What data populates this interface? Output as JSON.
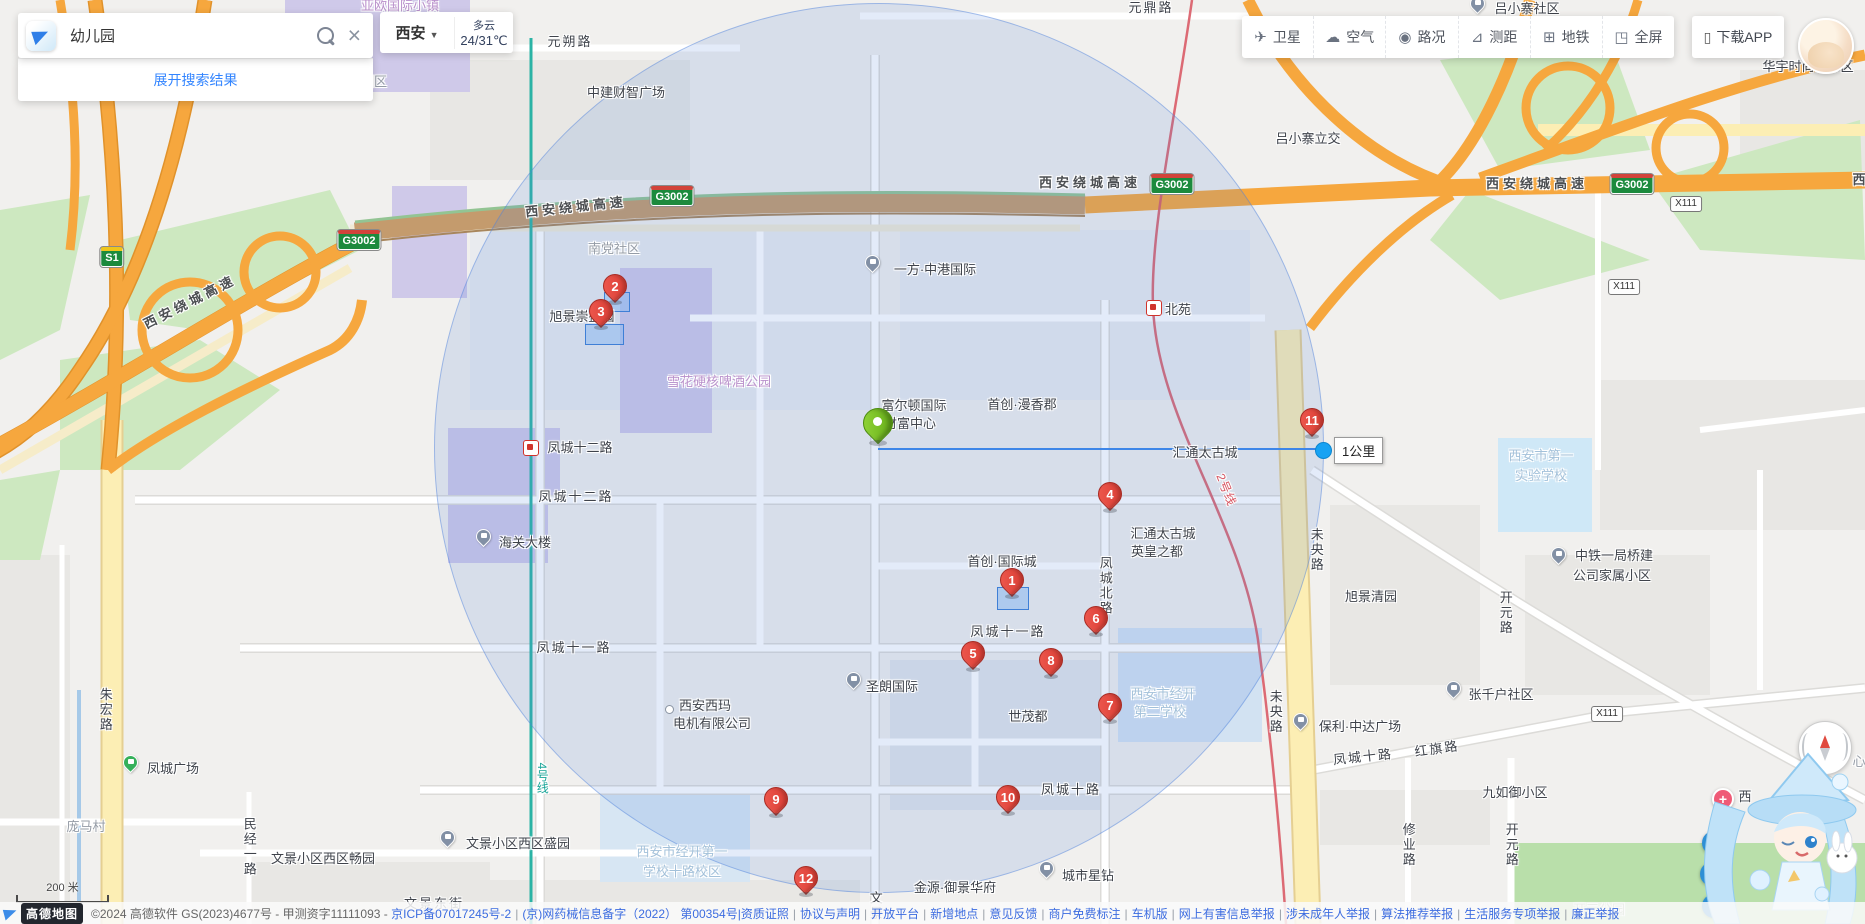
{
  "app": {
    "brand": "高德地图"
  },
  "search": {
    "query": "幼儿园",
    "expand_label": "展开搜索结果"
  },
  "city": {
    "name": "西安",
    "caret": "▼",
    "weather": "多云",
    "temp": "24/31℃"
  },
  "toolbar": {
    "items": [
      {
        "id": "satellite",
        "icon": "✈",
        "label": "卫星"
      },
      {
        "id": "air",
        "icon": "☁",
        "label": "空气"
      },
      {
        "id": "traffic",
        "icon": "◉",
        "label": "路况"
      },
      {
        "id": "measure",
        "icon": "⊿",
        "label": "测距"
      },
      {
        "id": "metro",
        "icon": "⊞",
        "label": "地铁"
      },
      {
        "id": "fullscreen",
        "icon": "◳",
        "label": "全屏"
      }
    ],
    "download_icon": "▯",
    "download_label": "下载APP"
  },
  "measure": {
    "label": "1公里",
    "x1": 878,
    "y": 449,
    "x2": 1322,
    "circle": {
      "cx": 878,
      "cy": 447,
      "r": 444
    }
  },
  "scale": {
    "label": "200 米"
  },
  "controls": {
    "buttons": [
      {
        "id": "refresh",
        "glyph": "↻",
        "x": 1714,
        "y": 843
      },
      {
        "id": "locate",
        "glyph": "◎",
        "x": 1712,
        "y": 874
      },
      {
        "id": "settings",
        "glyph": "⚙",
        "x": 1714,
        "y": 906
      }
    ]
  },
  "footer": {
    "logo_text": "高德地图",
    "copyright": "©2024 高德软件 GS(2023)4677号 - 甲测资字11111093 -",
    "links": [
      "京ICP备07017245号-2",
      "(京)网药械信息备字（2022） 第00354号|资质证照",
      "协议与声明",
      "开放平台",
      "新增地点",
      "意见反馈",
      "商户免费标注",
      "车机版",
      "网上有害信息举报",
      "涉未成年人举报",
      "算法推荐举报",
      "生活服务专项举报",
      "廉正举报"
    ]
  },
  "map": {
    "center_pin": {
      "x": 878,
      "y": 423
    },
    "markers": [
      {
        "n": "1",
        "x": 1012,
        "y": 580
      },
      {
        "n": "2",
        "x": 615,
        "y": 286
      },
      {
        "n": "3",
        "x": 601,
        "y": 311
      },
      {
        "n": "4",
        "x": 1110,
        "y": 494
      },
      {
        "n": "5",
        "x": 973,
        "y": 653
      },
      {
        "n": "6",
        "x": 1096,
        "y": 618
      },
      {
        "n": "7",
        "x": 1110,
        "y": 705
      },
      {
        "n": "8",
        "x": 1051,
        "y": 660
      },
      {
        "n": "9",
        "x": 776,
        "y": 799
      },
      {
        "n": "10",
        "x": 1008,
        "y": 797
      },
      {
        "n": "11",
        "x": 1312,
        "y": 420
      },
      {
        "n": "12",
        "x": 806,
        "y": 878
      }
    ],
    "highlight_buildings": [
      {
        "x": 997,
        "y": 587,
        "w": 30,
        "h": 21
      },
      {
        "x": 604,
        "y": 292,
        "w": 24,
        "h": 18
      },
      {
        "x": 585,
        "y": 324,
        "w": 37,
        "h": 19
      }
    ],
    "stations": [
      {
        "name": "凤城十二路",
        "x": 530,
        "y": 447
      },
      {
        "name": "北苑",
        "x": 1153,
        "y": 307
      }
    ],
    "badges": [
      {
        "t": "S1",
        "k": "s",
        "x": 112,
        "y": 257
      },
      {
        "t": "G3002",
        "k": "g",
        "x": 359,
        "y": 240
      },
      {
        "t": "G3002",
        "k": "g",
        "x": 672,
        "y": 196
      },
      {
        "t": "G3002",
        "k": "g",
        "x": 1172,
        "y": 184
      },
      {
        "t": "G3002",
        "k": "g",
        "x": 1632,
        "y": 184
      },
      {
        "t": "X111",
        "k": "x",
        "x": 1686,
        "y": 204
      },
      {
        "t": "X111",
        "k": "x",
        "x": 1624,
        "y": 287
      },
      {
        "t": "X111",
        "k": "x",
        "x": 1607,
        "y": 714
      }
    ],
    "icons": [
      {
        "k": "building",
        "x": 872,
        "y": 268
      },
      {
        "k": "building",
        "x": 1477,
        "y": 9
      },
      {
        "k": "building",
        "x": 483,
        "y": 542
      },
      {
        "k": "building",
        "x": 853,
        "y": 685
      },
      {
        "k": "building",
        "x": 1558,
        "y": 560
      },
      {
        "k": "building",
        "x": 1453,
        "y": 694
      },
      {
        "k": "building",
        "x": 1300,
        "y": 726
      },
      {
        "k": "building",
        "x": 1046,
        "y": 874
      },
      {
        "k": "building",
        "x": 447,
        "y": 843
      },
      {
        "k": "tree",
        "x": 130,
        "y": 768
      },
      {
        "k": "dot",
        "x": 668,
        "y": 708
      },
      {
        "k": "plus",
        "x": 1721,
        "y": 797,
        "glyph": "+"
      }
    ],
    "labels": [
      {
        "t": "元朔路",
        "x": 570,
        "y": 42,
        "c": "road"
      },
      {
        "t": "元鼎路",
        "x": 1151,
        "y": 8,
        "c": "road"
      },
      {
        "t": "亚欧国际小镇",
        "x": 400,
        "y": 6,
        "c": "purple"
      },
      {
        "t": "园区",
        "x": 374,
        "y": 82,
        "c": "muted"
      },
      {
        "t": "中建财智广场",
        "x": 626,
        "y": 93,
        "c": "area"
      },
      {
        "t": "吕小寨社区",
        "x": 1527,
        "y": 9,
        "c": "area"
      },
      {
        "t": "华宇时尚城东区",
        "x": 1808,
        "y": 67,
        "c": "area"
      },
      {
        "t": "吕小寨立交",
        "x": 1308,
        "y": 139,
        "c": "area"
      },
      {
        "t": "西安绕城高速",
        "x": 190,
        "y": 302,
        "c": "hw",
        "r": -27
      },
      {
        "t": "西安绕城高速",
        "x": 576,
        "y": 207,
        "c": "hw",
        "r": -6
      },
      {
        "t": "西安绕城高速",
        "x": 1090,
        "y": 183,
        "c": "hw"
      },
      {
        "t": "西安绕城高速",
        "x": 1537,
        "y": 184,
        "c": "hw"
      },
      {
        "t": "西",
        "x": 1861,
        "y": 180,
        "c": "hw"
      },
      {
        "t": "南党社区",
        "x": 614,
        "y": 249,
        "c": "muted"
      },
      {
        "t": "旭景崇盛园",
        "x": 582,
        "y": 317,
        "c": "area"
      },
      {
        "t": "雪花硬核啤酒公园",
        "x": 719,
        "y": 382,
        "c": "purple"
      },
      {
        "t": "一方·中港国际",
        "x": 935,
        "y": 270,
        "c": "area"
      },
      {
        "t": "北苑",
        "x": 1178,
        "y": 310,
        "c": "area"
      },
      {
        "t": "首创·漫香郡",
        "x": 1022,
        "y": 405,
        "c": "area"
      },
      {
        "t": "富尔顿国际",
        "x": 914,
        "y": 406,
        "c": "area"
      },
      {
        "t": "财富中心",
        "x": 910,
        "y": 424,
        "c": "area"
      },
      {
        "t": "汇通太古城",
        "x": 1205,
        "y": 453,
        "c": "area"
      },
      {
        "t": "凤城十二路",
        "x": 580,
        "y": 448,
        "c": "area"
      },
      {
        "t": "凤城十二路",
        "x": 576,
        "y": 497,
        "c": "road"
      },
      {
        "t": "汇通太古城",
        "x": 1163,
        "y": 534,
        "c": "area"
      },
      {
        "t": "英皇之都",
        "x": 1157,
        "y": 552,
        "c": "area"
      },
      {
        "t": "凤城北路",
        "x": 1105,
        "y": 586,
        "c": "roadv"
      },
      {
        "t": "未央路",
        "x": 1316,
        "y": 550,
        "c": "roadv"
      },
      {
        "t": "未央路",
        "x": 1275,
        "y": 712,
        "c": "roadv"
      },
      {
        "t": "旭景清园",
        "x": 1371,
        "y": 597,
        "c": "area"
      },
      {
        "t": "西安市第一",
        "x": 1541,
        "y": 456,
        "c": "school"
      },
      {
        "t": "实验学校",
        "x": 1541,
        "y": 476,
        "c": "school"
      },
      {
        "t": "中铁一局桥建",
        "x": 1614,
        "y": 556,
        "c": "area"
      },
      {
        "t": "公司家属小区",
        "x": 1612,
        "y": 576,
        "c": "area"
      },
      {
        "t": "开元路",
        "x": 1505,
        "y": 613,
        "c": "roadv"
      },
      {
        "t": "海关大楼",
        "x": 525,
        "y": 543,
        "c": "area"
      },
      {
        "t": "首创·国际城",
        "x": 1002,
        "y": 562,
        "c": "area"
      },
      {
        "t": "凤城十一路",
        "x": 1008,
        "y": 632,
        "c": "road"
      },
      {
        "t": "凤城十一路",
        "x": 574,
        "y": 648,
        "c": "road"
      },
      {
        "t": "圣朗国际",
        "x": 892,
        "y": 687,
        "c": "area"
      },
      {
        "t": "西安西玛",
        "x": 705,
        "y": 706,
        "c": "area"
      },
      {
        "t": "电机有限公司",
        "x": 712,
        "y": 724,
        "c": "area"
      },
      {
        "t": "世茂都",
        "x": 1028,
        "y": 717,
        "c": "area"
      },
      {
        "t": "西安市经开",
        "x": 1163,
        "y": 694,
        "c": "school"
      },
      {
        "t": "第二学校",
        "x": 1160,
        "y": 712,
        "c": "school"
      },
      {
        "t": "张千户社区",
        "x": 1501,
        "y": 695,
        "c": "area"
      },
      {
        "t": "保利·中达广场",
        "x": 1360,
        "y": 727,
        "c": "area"
      },
      {
        "t": "红旗路",
        "x": 1437,
        "y": 749,
        "c": "road",
        "r": -8
      },
      {
        "t": "凤城十路",
        "x": 1071,
        "y": 790,
        "c": "road"
      },
      {
        "t": "凤城十路",
        "x": 1363,
        "y": 757,
        "c": "road",
        "r": -6
      },
      {
        "t": "九如御小区",
        "x": 1515,
        "y": 793,
        "c": "area"
      },
      {
        "t": "修业路",
        "x": 1408,
        "y": 845,
        "c": "roadv"
      },
      {
        "t": "开元路",
        "x": 1511,
        "y": 845,
        "c": "roadv"
      },
      {
        "t": "开元公园",
        "x": 1599,
        "y": 910,
        "c": "park"
      },
      {
        "t": "凤城广场",
        "x": 173,
        "y": 769,
        "c": "area"
      },
      {
        "t": "庞马村",
        "x": 86,
        "y": 827,
        "c": "muted"
      },
      {
        "t": "朱宏路",
        "x": 105,
        "y": 710,
        "c": "roadv"
      },
      {
        "t": "民经一路",
        "x": 249,
        "y": 847,
        "c": "roadv"
      },
      {
        "t": "文景小区西区畅园",
        "x": 323,
        "y": 859,
        "c": "area"
      },
      {
        "t": "文景小区西区盛园",
        "x": 518,
        "y": 844,
        "c": "area"
      },
      {
        "t": "西安市经开第一",
        "x": 682,
        "y": 852,
        "c": "school"
      },
      {
        "t": "学校十路校区",
        "x": 682,
        "y": 872,
        "c": "school"
      },
      {
        "t": "金源·御景华府",
        "x": 955,
        "y": 888,
        "c": "area"
      },
      {
        "t": "城市星钻",
        "x": 1088,
        "y": 876,
        "c": "area"
      },
      {
        "t": "文景",
        "x": 875,
        "y": 906,
        "c": "roadv"
      },
      {
        "t": "文景东街",
        "x": 434,
        "y": 904,
        "c": "road"
      },
      {
        "t": "4号线",
        "x": 542,
        "y": 778,
        "c": "metro4"
      },
      {
        "t": "2号线",
        "x": 1226,
        "y": 490,
        "c": "metro2",
        "r": 68
      },
      {
        "t": "西",
        "x": 1745,
        "y": 797,
        "c": "area"
      },
      {
        "t": "心",
        "x": 1859,
        "y": 762,
        "c": "muted"
      }
    ]
  }
}
